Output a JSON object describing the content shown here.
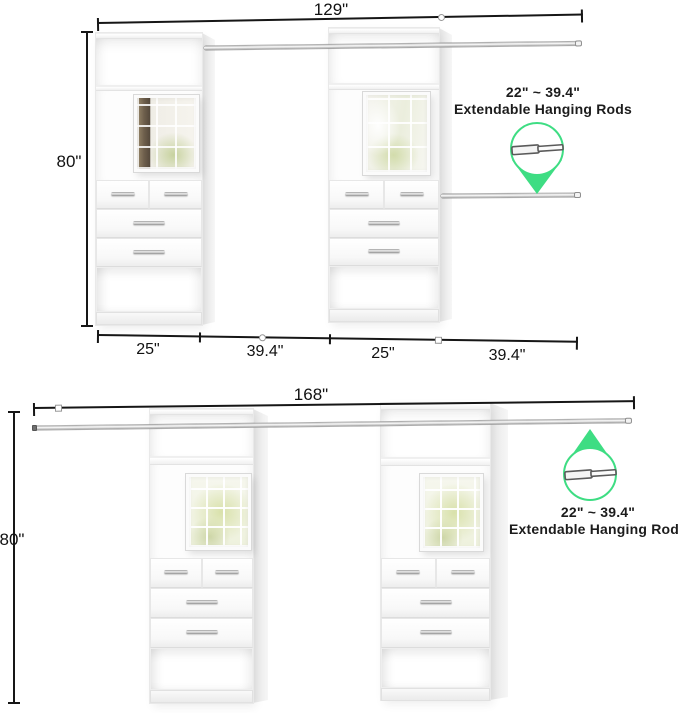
{
  "top_diagram": {
    "width_label": "129\"",
    "height_label": "80\"",
    "segments": [
      "25\"",
      "39.4\"",
      "25\"",
      "39.4\""
    ],
    "callout": {
      "line1": "22\" ~ 39.4\"",
      "line2": "Extendable Hanging Rods"
    }
  },
  "bottom_diagram": {
    "width_label": "168\"",
    "height_label": "80\"",
    "callout": {
      "line1": "22\" ~ 39.4\"",
      "line2": "Extendable Hanging Rods"
    }
  },
  "colors": {
    "accent_green": "#3edd83",
    "dimension_line": "#161616",
    "rod_silver": "#c9c9c9"
  }
}
